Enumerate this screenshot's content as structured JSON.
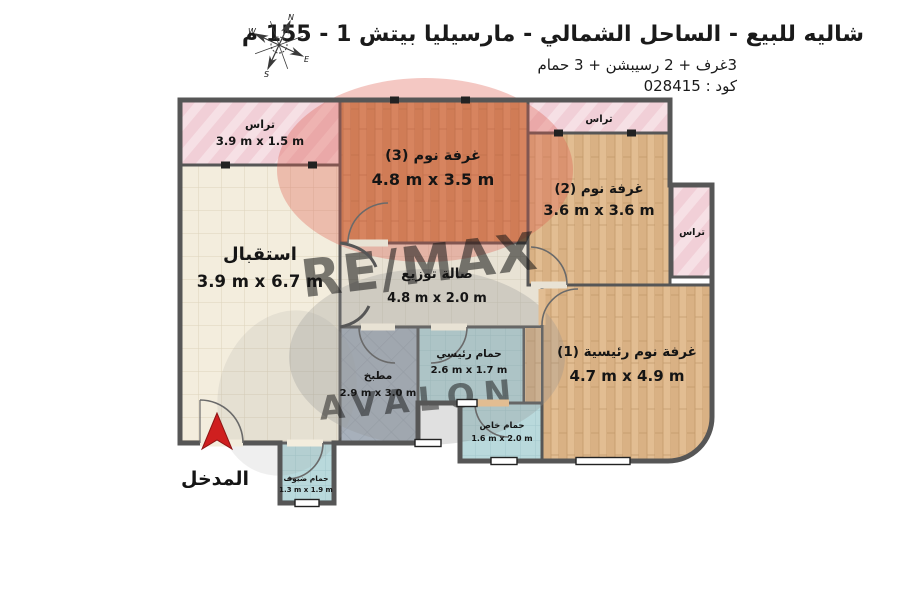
{
  "header": {
    "title": "شاليه للبيع - الساحل الشمالي - مارسيليا بيتش 1 - 155 م",
    "subtitle": "3غرف + 2 رسيبشن + 3 حمام",
    "code": "كود : 028415"
  },
  "compass": {
    "n": "N",
    "e": "E",
    "s": "S",
    "w": "W"
  },
  "rooms": [
    {
      "id": "terrace_top_left",
      "name": "تراس",
      "dims": "3.9 m x 1.5 m"
    },
    {
      "id": "bedroom_3",
      "name": "غرفة نوم (3)",
      "dims": "4.8 m x 3.5 m"
    },
    {
      "id": "terrace_top_right",
      "name": "تراس",
      "dims": ""
    },
    {
      "id": "bedroom_2",
      "name": "غرفة نوم (2)",
      "dims": "3.6 m x 3.6 m"
    },
    {
      "id": "terrace_right",
      "name": "تراس",
      "dims": ""
    },
    {
      "id": "reception",
      "name": "استقبال",
      "dims": "3.9 m x 6.7 m"
    },
    {
      "id": "hall",
      "name": "صالة توزيع",
      "dims": "4.8 m x 2.0 m"
    },
    {
      "id": "kitchen",
      "name": "مطبخ",
      "dims": "2.9 m x 3.0 m"
    },
    {
      "id": "bathroom_main",
      "name": "حمام رئيسي",
      "dims": "2.6 m x 1.7 m"
    },
    {
      "id": "master_bedroom",
      "name": "غرفة نوم رئيسية (1)",
      "dims": "4.7 m x 4.9 m"
    },
    {
      "id": "bathroom_private",
      "name": "حمام خاص",
      "dims": "1.6 m x 2.0 m"
    },
    {
      "id": "bathroom_guest",
      "name": "حمام ضيوف",
      "dims": "1.3 m x 1.9 m"
    }
  ],
  "entrance": {
    "label": "المدخل"
  },
  "watermark": {
    "brand": "RE/MAX",
    "sub": "AVALON"
  },
  "colors": {
    "wall": "#565656",
    "terrace_pink": "#f1cfd7",
    "wood_dark": "#d49a6a",
    "wood_light": "#e2bd92",
    "reception_cream": "#f3eddd",
    "hall_tile": "#e8e2d4",
    "kitchen_gray": "#a7b0bb",
    "bath_teal": "#b9d9dc",
    "entrance_red": "#cf1f1f",
    "watermark_red": "#c63832"
  }
}
